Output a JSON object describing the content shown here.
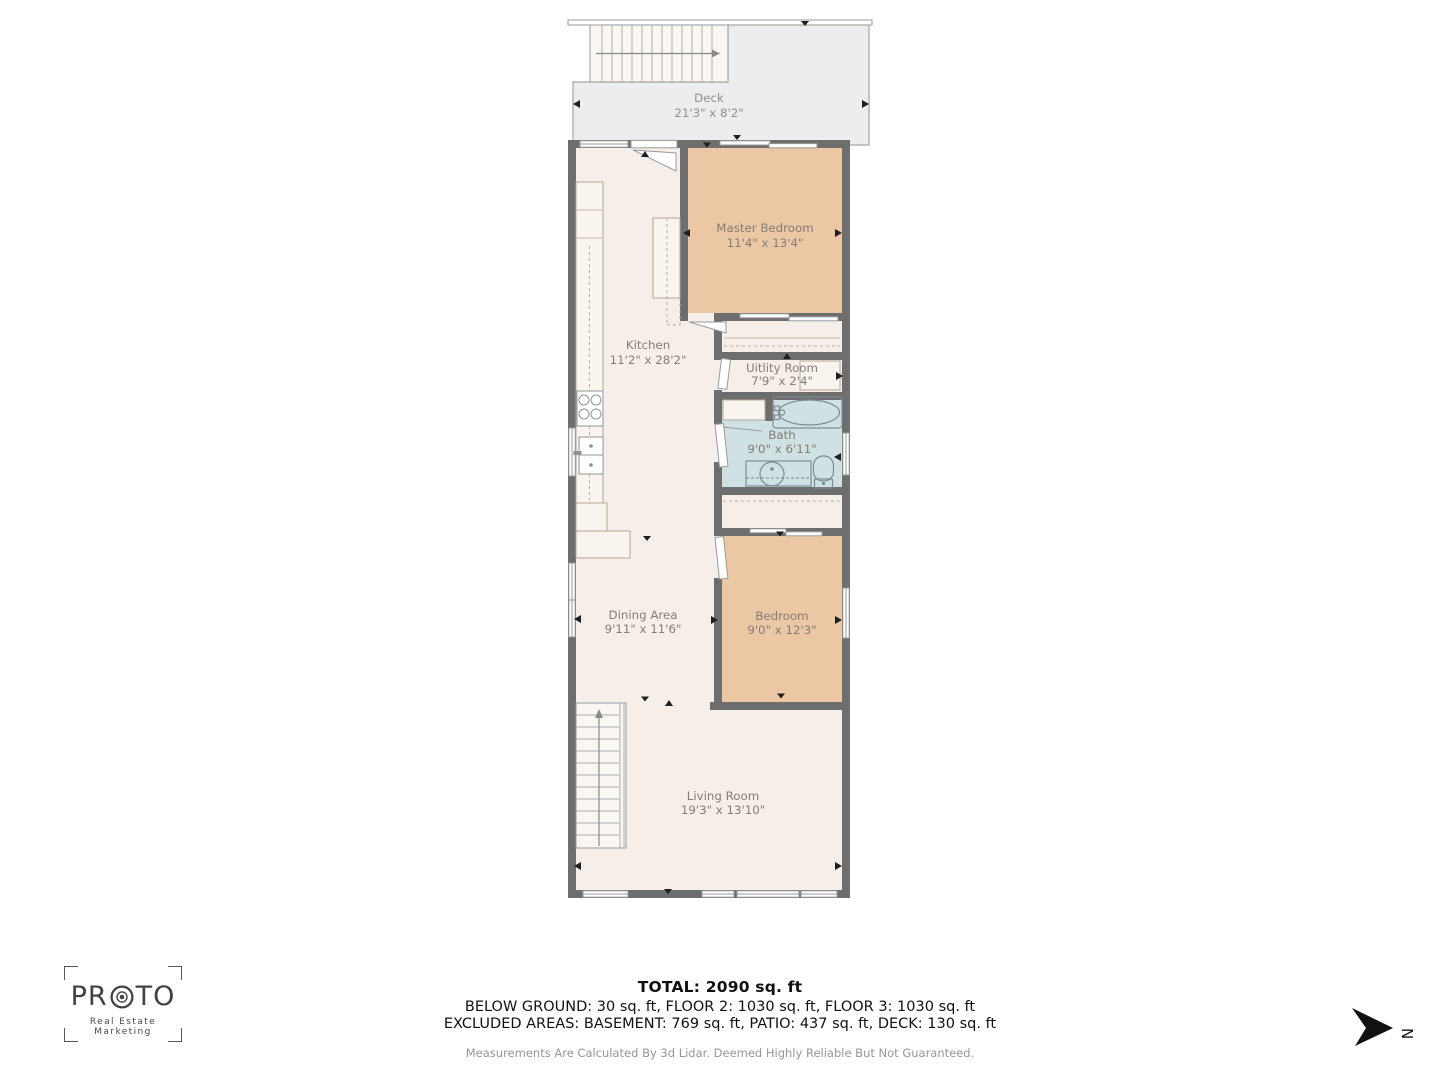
{
  "page": {
    "background": "#ffffff"
  },
  "plan": {
    "rooms": {
      "deck": {
        "name": "Deck",
        "dims": "21'3\" x 8'2\""
      },
      "master_bedroom": {
        "name": "Master Bedroom",
        "dims": "11'4\" x 13'4\""
      },
      "kitchen": {
        "name": "Kitchen",
        "dims": "11'2\" x 28'2\""
      },
      "utility_room": {
        "name": "Uitlity Room",
        "dims": "7'9\" x 2'4\""
      },
      "bath": {
        "name": "Bath",
        "dims": "9'0\" x 6'11\""
      },
      "dining_area": {
        "name": "Dining Area",
        "dims": "9'11\" x 11'6\""
      },
      "bedroom": {
        "name": "Bedroom",
        "dims": "9'0\" x 12'3\""
      },
      "living_room": {
        "name": "Living Room",
        "dims": "19'3\" x 13'10\""
      }
    },
    "colors": {
      "wall": "#6e6e6e",
      "floor": "#f6efe9",
      "bedroom_fill": "#ecc7a3",
      "bath_fill": "#cfe1e3",
      "deck_fill": "#ebedee",
      "label_text": "#837d77"
    }
  },
  "footer": {
    "total": "TOTAL: 2090 sq. ft",
    "floors": "BELOW GROUND: 30 sq. ft, FLOOR 2: 1030 sq. ft, FLOOR 3: 1030 sq. ft",
    "excluded": "EXCLUDED AREAS: BASEMENT: 769 sq. ft, PATIO: 437 sq. ft, DECK: 130 sq. ft",
    "disclaimer": "Measurements Are Calculated By 3d Lidar. Deemed Highly Reliable But Not Guaranteed."
  },
  "logo": {
    "brand_pre": "PR",
    "brand_post": "TO",
    "tagline": "Real Estate Marketing"
  },
  "compass": {
    "north_label": "N"
  }
}
